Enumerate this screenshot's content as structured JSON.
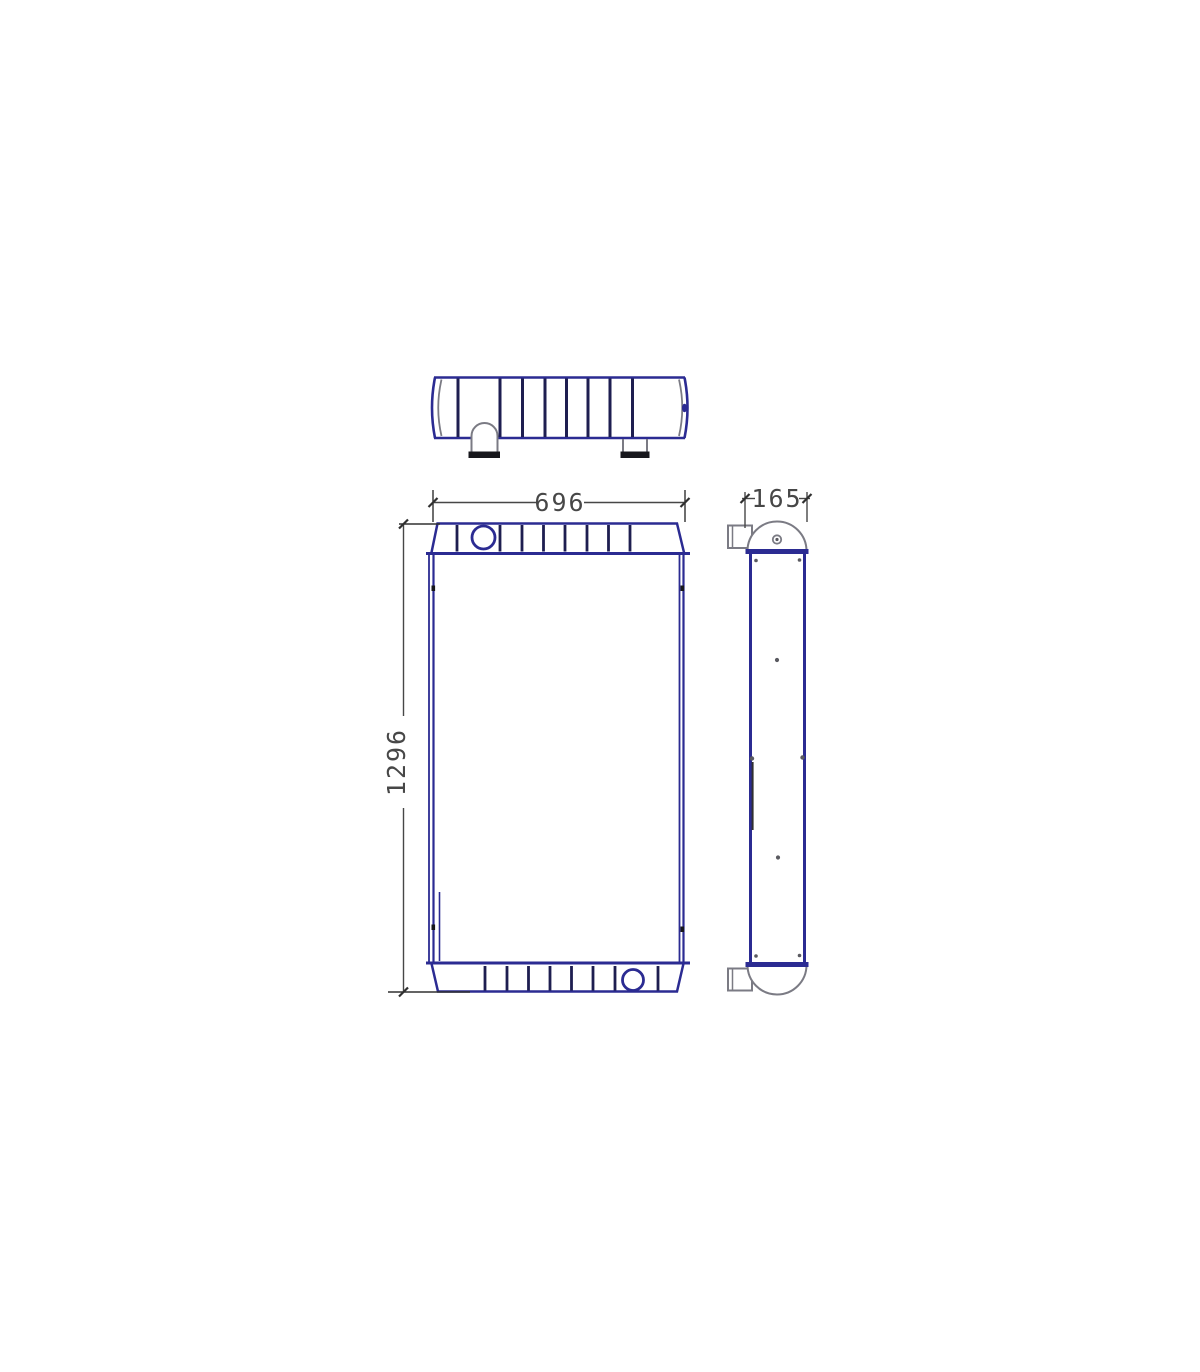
{
  "drawing": {
    "dimension_width_mm": "696",
    "dimension_height_mm": "1296",
    "dimension_depth_mm": "165"
  },
  "colors": {
    "line_blue": "#2b2b92",
    "rib_navy": "#1e1e50",
    "dim_gray": "#474747",
    "dim_dark": "#303030",
    "shape_gray": "#7b7b84",
    "dot_gray": "#5a5a60",
    "mark_black": "#17171c",
    "bg": "#ffffff"
  }
}
